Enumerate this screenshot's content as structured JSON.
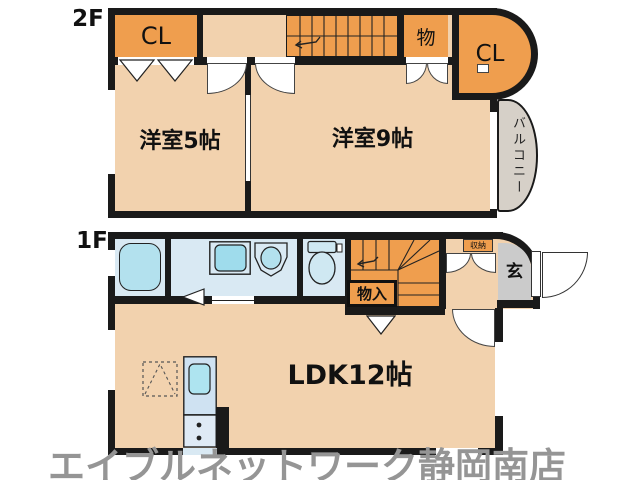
{
  "title": "間取り図",
  "floor2": {
    "label": "2F",
    "closet_left": "CL",
    "storage": "物",
    "closet_right": "CL",
    "room_small": "洋室5帖",
    "room_large": "洋室9帖",
    "balcony": "バルコニー"
  },
  "floor1": {
    "label": "1F",
    "storage": "物入",
    "shoe_storage": "収納",
    "entrance": "玄",
    "ldk": "LDK12帖"
  },
  "watermark": "エイブルネットワーク静岡南店",
  "colors": {
    "wall": "#1a1a1a",
    "floor_peach": "#f2d2ae",
    "accent_orange": "#ef9e4e",
    "wet_area_blue": "#d9e9f3",
    "fixture_cyan": "#b3e1ee",
    "balcony_gray": "#d6d0c8",
    "entrance_gray": "#cbcbcb",
    "watermark_gray": "#959595"
  }
}
